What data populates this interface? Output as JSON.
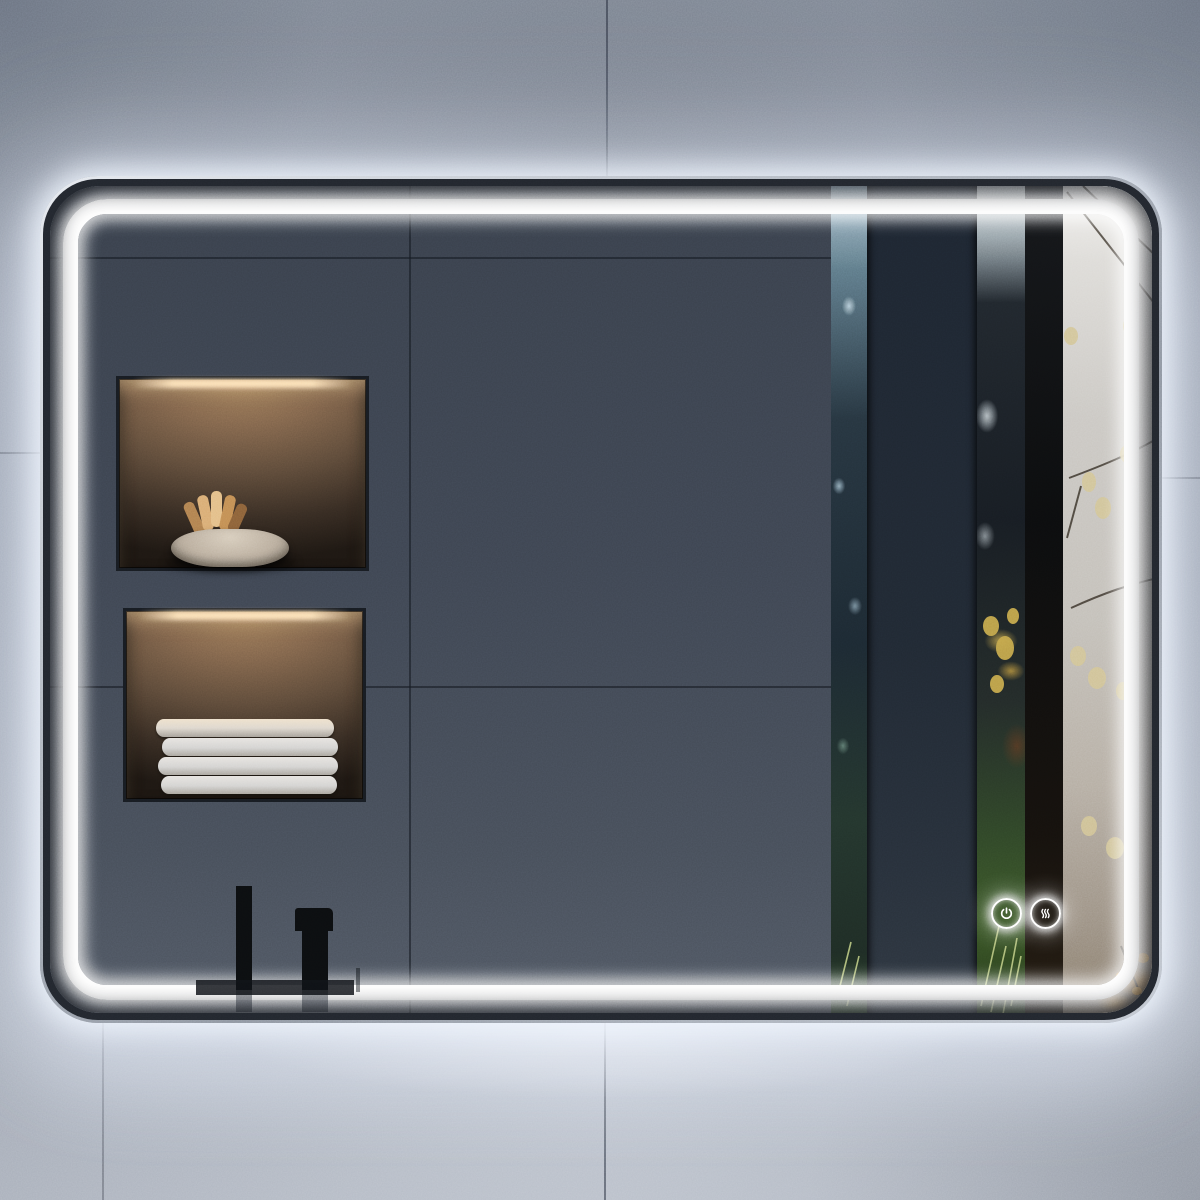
{
  "scene": {
    "type": "product-photo",
    "subject": "LED backlit bathroom mirror with rounded corners on a concrete tile wall",
    "wall": {
      "material": "concrete-tile",
      "base_color": "#8b93a1",
      "grout_color": "#2c323e"
    },
    "mirror": {
      "frame_color": "#b7bdc6",
      "bezel_color": "#22262d",
      "led_color": "#ffffff",
      "reflection": {
        "wall_color": "#3d4450",
        "left_scene": "dark slate tiled wall with two backlit storage niches",
        "right_scene": "autumn forest with dark window band, tree trunks and mist",
        "fixture": "matte black faucet"
      }
    },
    "niche_upper": {
      "contents": "textured stone bowl with folded tan cloths",
      "light_color": "#ffe4b9"
    },
    "niche_lower": {
      "contents": "stack of four folded white towels",
      "light_color": "#ffe4b9"
    },
    "forest": {
      "mist_color": "#c7c3bc",
      "leaf_color": "#d2c494",
      "trunk_color": "#0c0d0e",
      "undergrowth_color": "#3a5527",
      "autumn_accent": "#c08335"
    },
    "controls": {
      "panel": "touch-control-panel",
      "buttons": [
        {
          "id": "power",
          "label": "Power",
          "icon": "power-icon"
        },
        {
          "id": "defog",
          "label": "Anti-fog heat",
          "icon": "defogger-icon"
        }
      ]
    }
  }
}
